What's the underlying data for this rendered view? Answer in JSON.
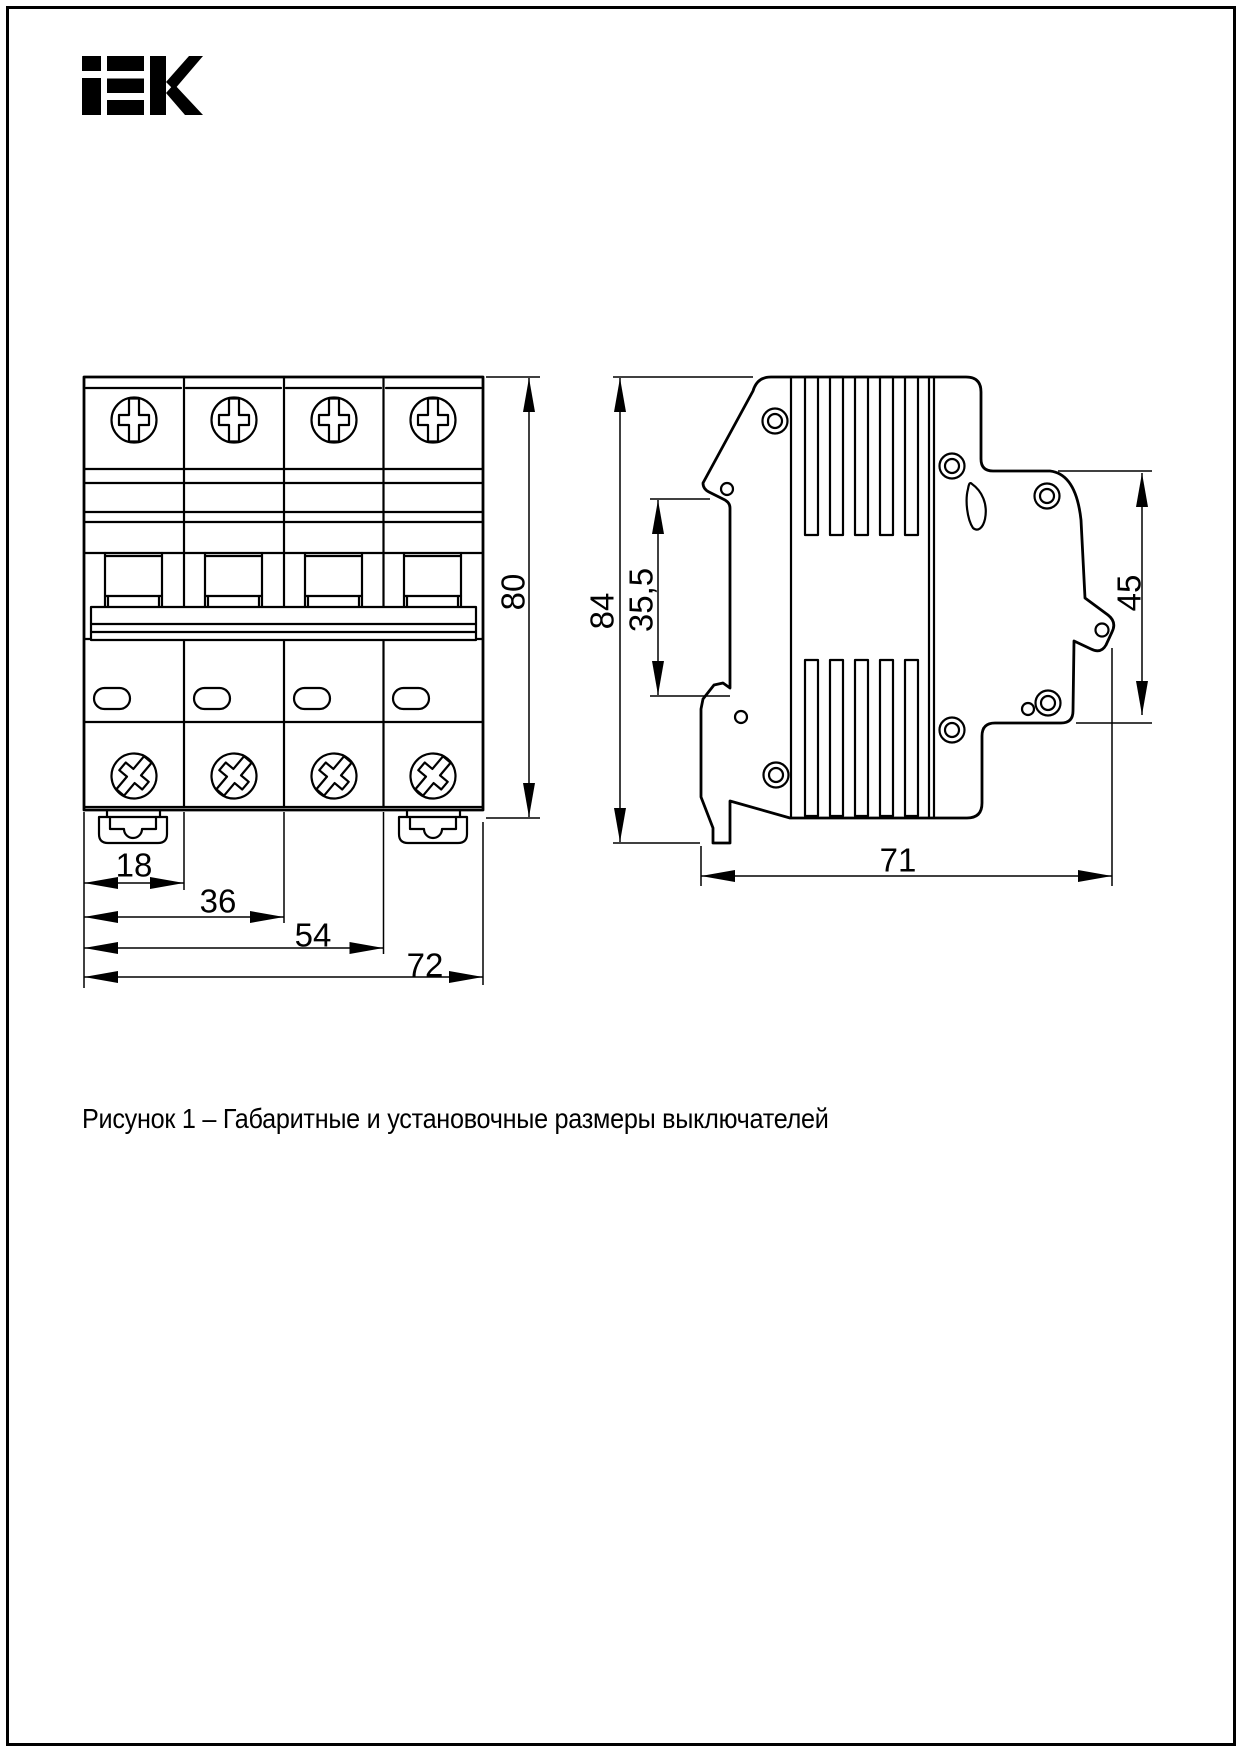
{
  "page": {
    "background": "#ffffff",
    "border_color": "#000000",
    "ink": "#000000"
  },
  "logo": {
    "text": "IEK"
  },
  "figure_caption": "Рисунок 1 – Габаритные и установочные размеры выключателей",
  "front_view": {
    "poles": 4,
    "dim_pole_width": "18",
    "dim_two_poles": "36",
    "dim_three_poles": "54",
    "dim_total_width": "72",
    "dim_height": "80"
  },
  "side_view": {
    "dim_height": "84",
    "dim_din_offset": "35,5",
    "dim_terminal_depth": "45",
    "dim_total_depth": "71"
  }
}
